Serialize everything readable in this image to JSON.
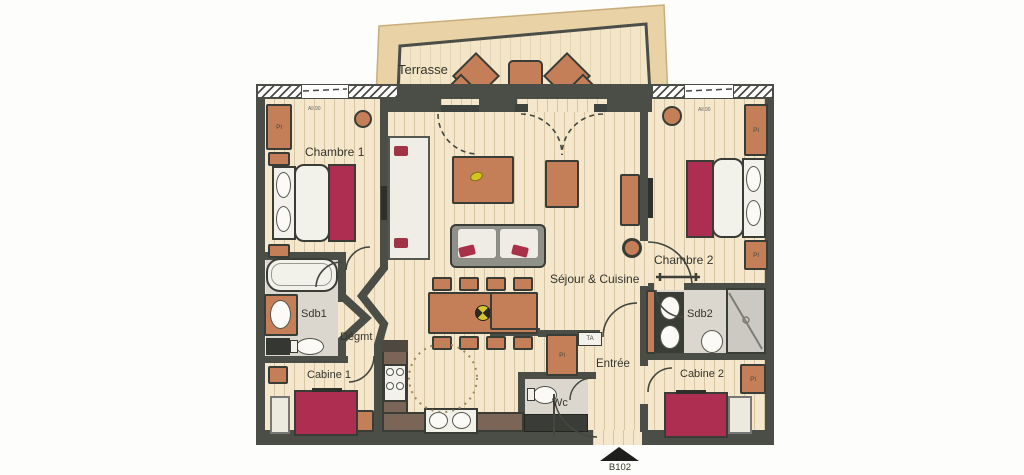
{
  "floorplan": {
    "unit_label": "B102",
    "rooms": {
      "terrasse": "Terrasse",
      "chambre1": "Chambre 1",
      "sejour_cuisine": "Séjour & Cuisine",
      "chambre2": "Chambre 2",
      "sdb1": "Sdb1",
      "degagement": "Dégmt",
      "cabine1": "Cabine 1",
      "entree": "Entrée",
      "wc": "Wc",
      "sdb2": "Sdb2",
      "cabine2": "Cabine 2"
    },
    "annotations": {
      "closet": "Pl",
      "electrical_panel": "TA",
      "window_sill_height": "All.90"
    },
    "colors": {
      "wall": "#4a4e47",
      "floor_wood": "#f4e7cc",
      "terrace_band": "#e9d2a6",
      "furniture_terracotta": "#c57f58",
      "bed_red": "#ae2e52",
      "bath_floor": "#dbd7cf",
      "counter_brown": "#7b6556",
      "accent_yellow": "#d3c420"
    }
  }
}
